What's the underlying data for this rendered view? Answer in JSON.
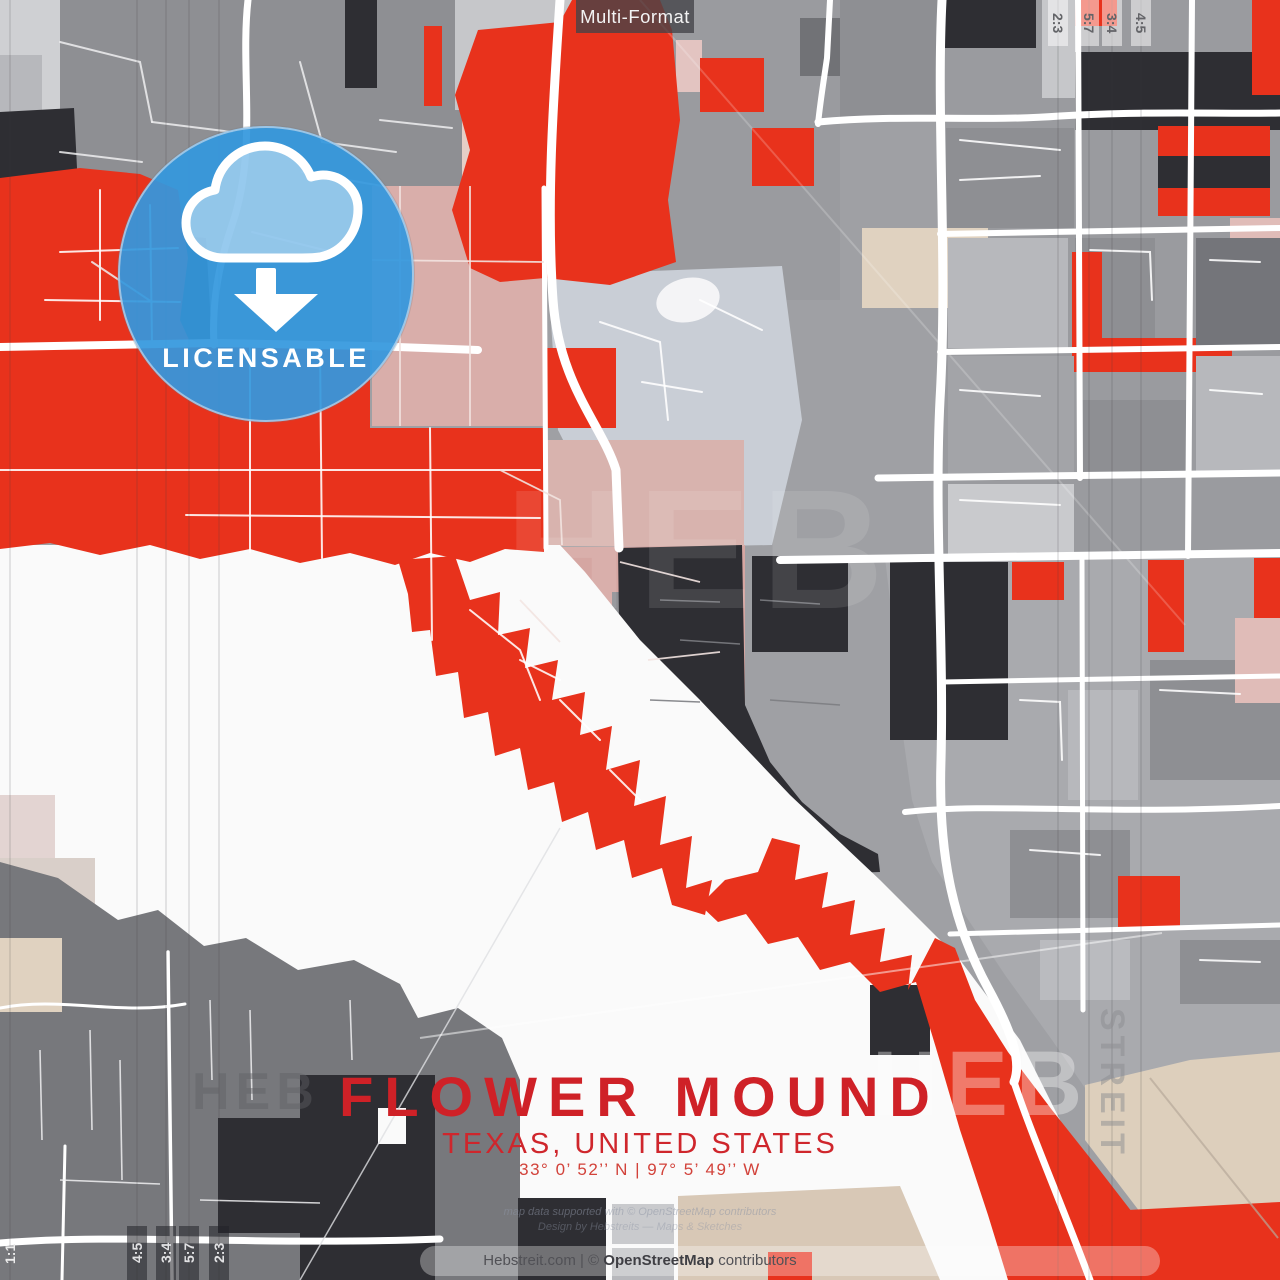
{
  "poster": {
    "format_label": "Multi-Format",
    "badge": {
      "label": "LICENSABLE"
    },
    "title": {
      "city": "FLOWER MOUND",
      "region": "TEXAS, UNITED STATES",
      "coordinates": "33° 0’ 52’’ N | 97° 5’ 49’’ W"
    },
    "footer": {
      "prefix": "Hebstreit.com | © ",
      "brand": "OpenStreetMap",
      "suffix": " contributors"
    },
    "fine_print": {
      "line1": "map data supported with © OpenStreetMap contributors",
      "line2": "Design by Hebstreits — Maps & Sketches"
    },
    "format_markers": {
      "bottom_left": [
        "1:1",
        "4:5",
        "3:4",
        "5:7",
        "2:3"
      ],
      "top_right": [
        "2:3",
        "5:7",
        "3:4",
        "4:5"
      ]
    },
    "watermarks": {
      "heb": "HEB",
      "streit": "STREIT"
    },
    "colors": {
      "accent_red": "#e8321c",
      "title_red": "#cf2127",
      "badge_blue": "#3598e2",
      "charcoal": "#2e2e33",
      "map_gray": "#8e8f93",
      "rose": "#d5a6a2",
      "dusty_pink": "#d9aeaa",
      "beige": "#e0d2c0",
      "lake_white": "#fafafa"
    }
  }
}
